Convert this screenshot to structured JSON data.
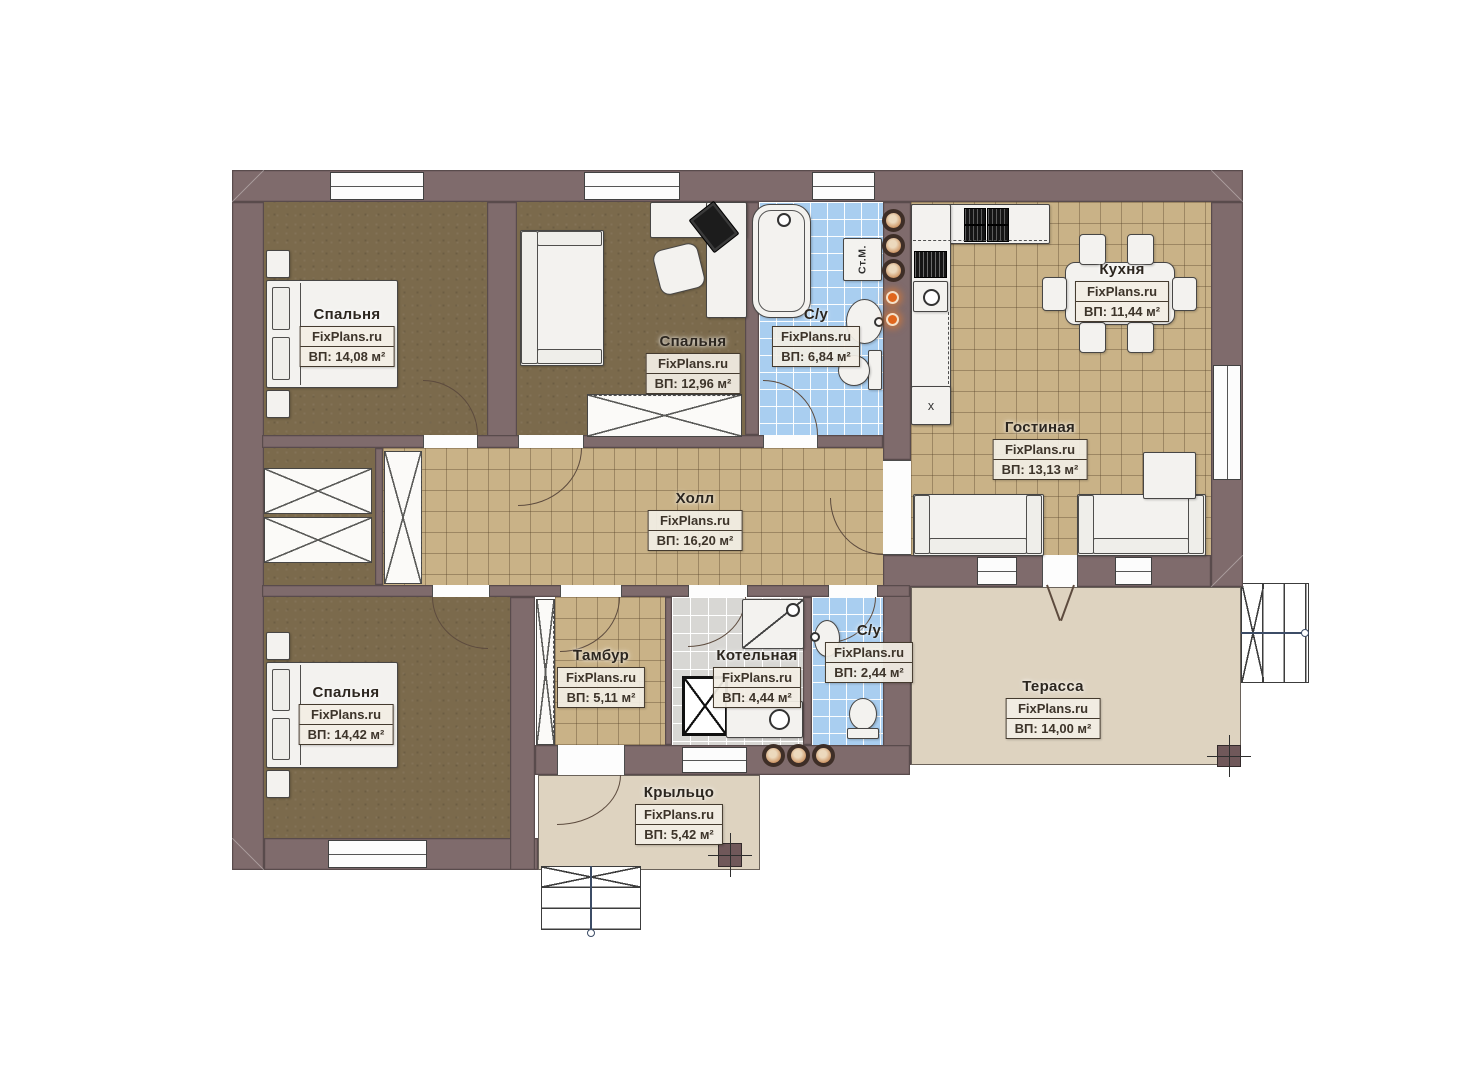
{
  "source_watermark": "FixPlans.ru",
  "rooms": [
    {
      "key": "bedroom-1",
      "name": "Спальня",
      "area_label": "ВП: 14,08 м²"
    },
    {
      "key": "bedroom-2",
      "name": "Спальня",
      "area_label": "ВП: 12,96 м²"
    },
    {
      "key": "bathroom-main",
      "name": "С/у",
      "area_label": "ВП: 6,84 м²"
    },
    {
      "key": "kitchen",
      "name": "Кухня",
      "area_label": "ВП: 11,44 м²"
    },
    {
      "key": "living-room",
      "name": "Гостиная",
      "area_label": "ВП: 13,13 м²"
    },
    {
      "key": "hall",
      "name": "Холл",
      "area_label": "ВП: 16,20 м²"
    },
    {
      "key": "bedroom-3",
      "name": "Спальня",
      "area_label": "ВП: 14,42 м²"
    },
    {
      "key": "vestibule",
      "name": "Тамбур",
      "area_label": "ВП: 5,11 м²"
    },
    {
      "key": "boiler-room",
      "name": "Котельная",
      "area_label": "ВП: 4,44 м²"
    },
    {
      "key": "bathroom-small",
      "name": "С/у",
      "area_label": "ВП: 2,44 м²"
    },
    {
      "key": "terrace",
      "name": "Терасса",
      "area_label": "ВП: 14,00 м²"
    },
    {
      "key": "porch",
      "name": "Крыльцо",
      "area_label": "ВП: 5,42 м²"
    }
  ],
  "fixtures": {
    "washing_machine_label": "Ст.М.",
    "fridge_label": "х"
  },
  "colors": {
    "wall": "#7f6b6c",
    "wood_floor": "#7b6a4c",
    "tile_tan": "#c9b287",
    "tile_blue": "#a9cef0",
    "tile_gray": "#d8d7d4",
    "deck": "#ded3c0",
    "label_bg": "#f2eee4",
    "label_line": "#443a2e",
    "accent_orange": "#e0661d"
  }
}
